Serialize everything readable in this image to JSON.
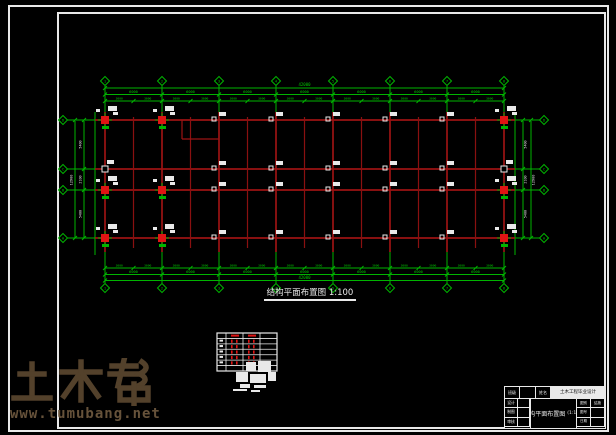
{
  "watermark": {
    "logo_text": "土木帮",
    "url_text": "www.tumubang.net"
  },
  "plan": {
    "title": "结构平面布置图 1:100",
    "colors": {
      "grid_green": "#00b400",
      "beam_red": "#9c1313",
      "column_red": "#e01414",
      "tag_white": "#e9e9e9",
      "dim_text_green": "#00cc00"
    },
    "axes": {
      "horizontal_labels": [
        "1",
        "2",
        "3",
        "4",
        "5",
        "6",
        "7",
        "8"
      ],
      "vertical_labels": [
        "D",
        "C",
        "B",
        "A"
      ]
    },
    "dimensions": {
      "top": {
        "total": "42000",
        "bay": "6000",
        "half": "3000"
      },
      "bottom": {
        "total": "42000",
        "bay": "6000",
        "half": "3000"
      },
      "left": {
        "total": "12900",
        "bays": [
          "5400",
          "2100",
          "5400"
        ]
      },
      "right": {
        "total": "12900",
        "bays": [
          "5400",
          "2100",
          "5400"
        ]
      }
    }
  },
  "column_schedule": {
    "rows": 7,
    "cols": 4
  },
  "title_block": {
    "row1_cells": [
      "班级",
      "",
      "姓名"
    ],
    "project_text": "土木工程毕业设计",
    "roles": [
      "设计",
      "制图",
      "审核"
    ],
    "drawing_title": "结构平面布置图",
    "scale_text": "(1:100)",
    "right_cells": [
      "图别",
      "结施",
      "图号",
      "",
      "日期",
      ""
    ]
  }
}
